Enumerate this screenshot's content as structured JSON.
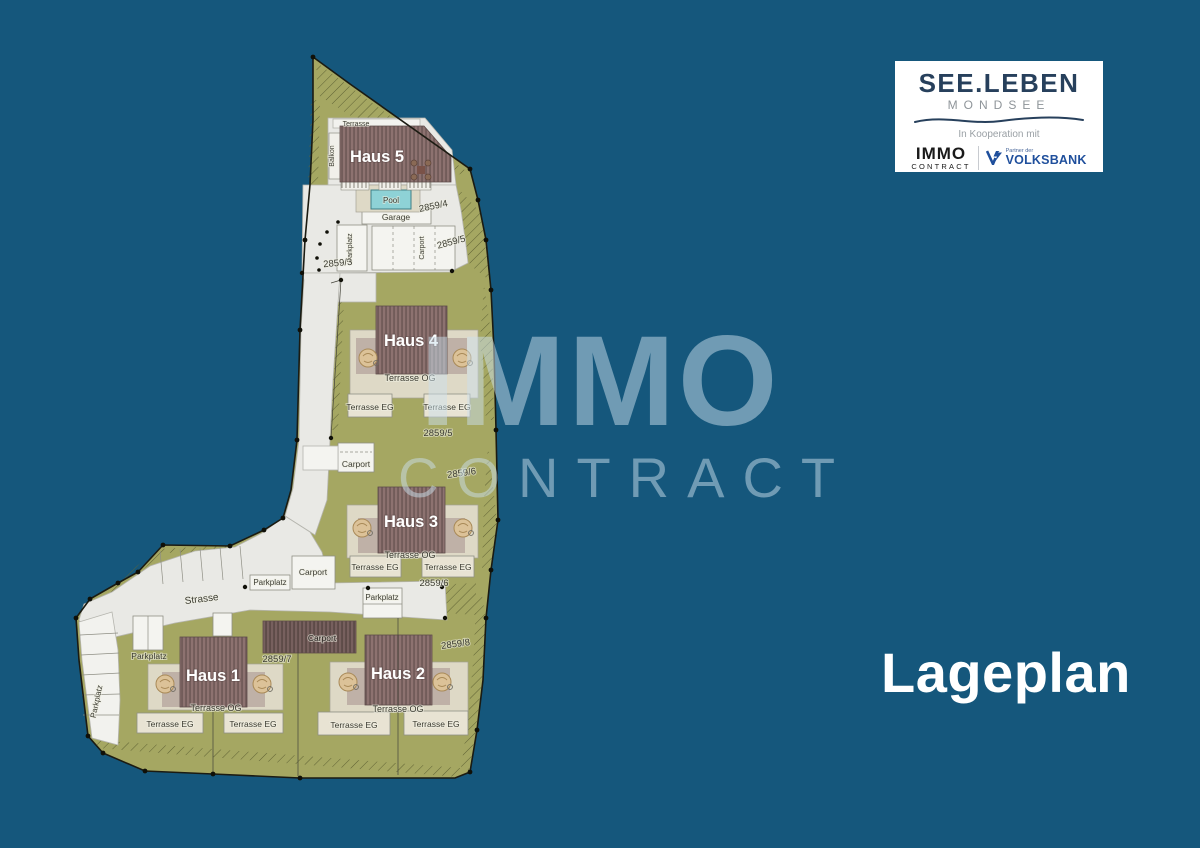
{
  "colors": {
    "background": "#15577c",
    "site_green": "#a5a762",
    "road_white": "#e9e9e5",
    "roof_mauve": "#8d7270",
    "deck_beige": "#ded9c6",
    "pool_teal": "#8ed2d6",
    "brand_navy": "#27405c",
    "volksbank_blue": "#1f4f9c",
    "watermark_blue": "rgba(203,223,235,0.5)"
  },
  "logo_card": {
    "brand": "SEE.LEBEN",
    "sub_brand": "MONDSEE",
    "cooperation": "In Kooperation mit",
    "partner1_name": "IMMO",
    "partner1_sub": "CONTRACT",
    "partner2_small": "Partner der",
    "partner2_name": "VOLKSBANK"
  },
  "watermark": {
    "top": "IMMO",
    "bottom": "CONTRACT"
  },
  "page_title": "Lageplan",
  "plan": {
    "houses": {
      "h1": "Haus 1",
      "h2": "Haus 2",
      "h3": "Haus 3",
      "h4": "Haus 4",
      "h5": "Haus 5"
    },
    "labels": {
      "strasse": "Strasse",
      "pool": "Pool",
      "garage": "Garage",
      "terrasse": "Terrasse",
      "balkon": "Balkon",
      "terrasse_og": "Terrasse OG",
      "terrasse_eg": "Terrasse EG",
      "carport": "Carport",
      "parkplatz": "Parkplatz"
    },
    "parcels": {
      "p3": "2859/3",
      "p4": "2859/4",
      "p5": "2859/5",
      "p6": "2859/6",
      "p7": "2859/7",
      "p8": "2859/8"
    }
  }
}
